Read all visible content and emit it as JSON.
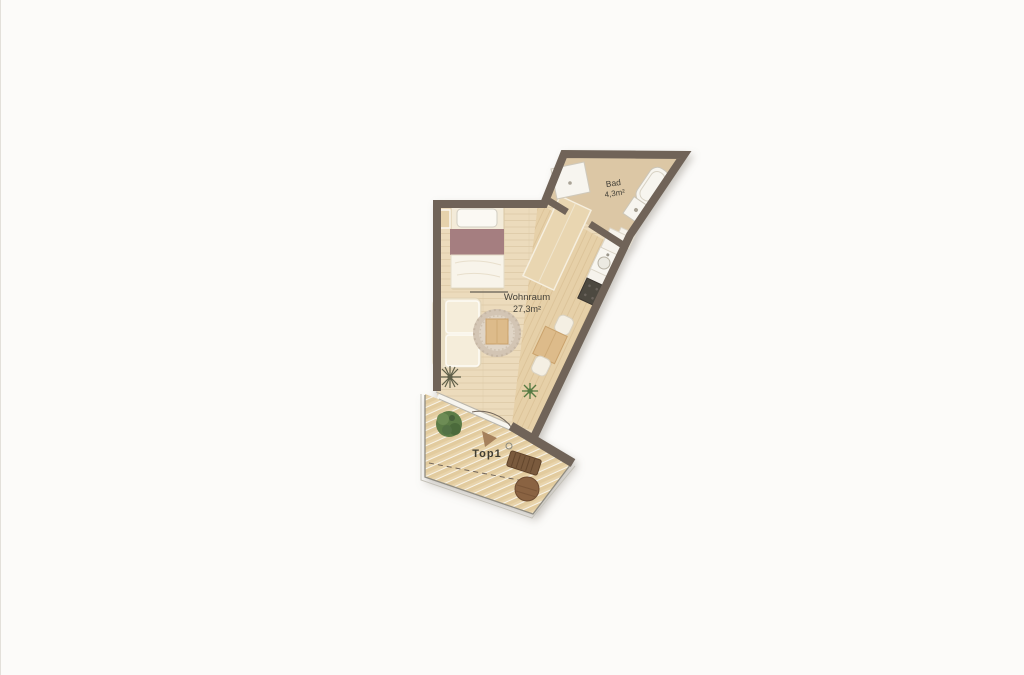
{
  "page": {
    "background": "#fcfbf9"
  },
  "floor_plan": {
    "unit_label": "Top1",
    "rooms": [
      {
        "name": "Wohnraum",
        "area": "27,3m²"
      },
      {
        "name": "Bad",
        "area": "4,3m²"
      }
    ],
    "colors": {
      "wall": "#6f6458",
      "floor": "#ecdbbc",
      "floor_strip": "#e6d0a8",
      "bath_floor": "#dcc7a5",
      "deck": "#e9d4ab",
      "blanket": "#a57e80",
      "sofa": "#f1e8d4",
      "wood": "#ddbb8a",
      "appliance_dark": "#4e4840",
      "plant_green": "#5b7b46",
      "bench_brown": "#7a5a3c",
      "table_round": "#8a6342",
      "label_text": "#45423a"
    }
  }
}
